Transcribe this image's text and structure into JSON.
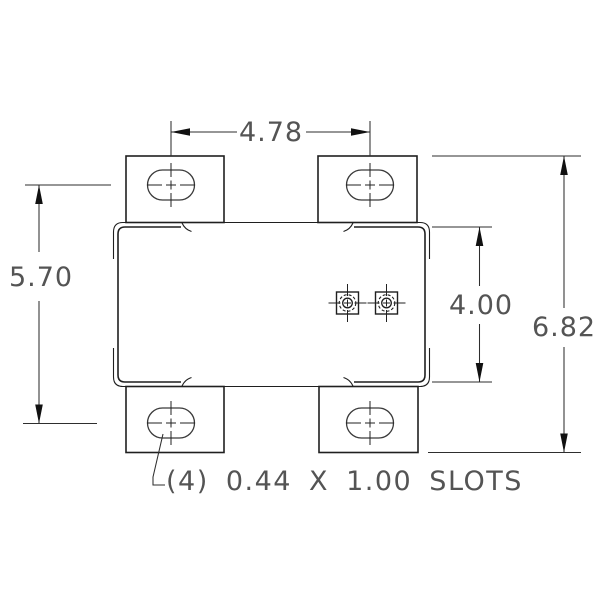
{
  "drawing": {
    "type": "mechanical-dimension-drawing",
    "background": "#ffffff",
    "line_color": "#1f1f1f",
    "dimension_line_color": "#2e2e2e",
    "text_color": "#545454",
    "dimensions": {
      "slot_center_width": "4.78",
      "slot_center_height": "5.70",
      "body_height": "4.00",
      "overall_height": "6.82"
    },
    "note": "(4) 0.44 X 1.00 SLOTS",
    "features": {
      "mounting_tabs": 4,
      "slots_per_tab": 1,
      "terminals": 2
    }
  }
}
